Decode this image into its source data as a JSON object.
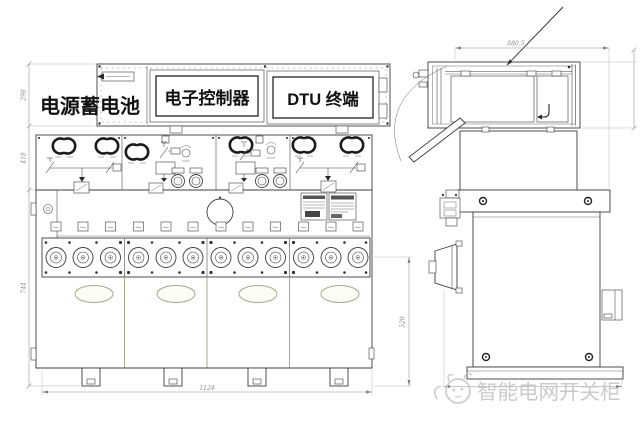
{
  "page": {
    "width": 640,
    "height": 422,
    "background": "#ffffff"
  },
  "callouts": {
    "battery": "电源蓄电池",
    "controller": "电子控制器",
    "dtu": "DTU 终端"
  },
  "watermark": {
    "text": "智能电网开关柜",
    "color": "#c5c5c5"
  },
  "dimensions": {
    "front_left_top": "298",
    "front_left_mid": "418",
    "front_left_bottom": "744",
    "front_bottom_width": "1124",
    "side_top_width": "880.5",
    "side_height": "520"
  },
  "colors": {
    "line": "#3c3c3c",
    "dim_line": "#909090",
    "dim_text": "#8a8a8a",
    "accent_olive": "#a9a98e",
    "watermark": "#c5c5c5"
  }
}
